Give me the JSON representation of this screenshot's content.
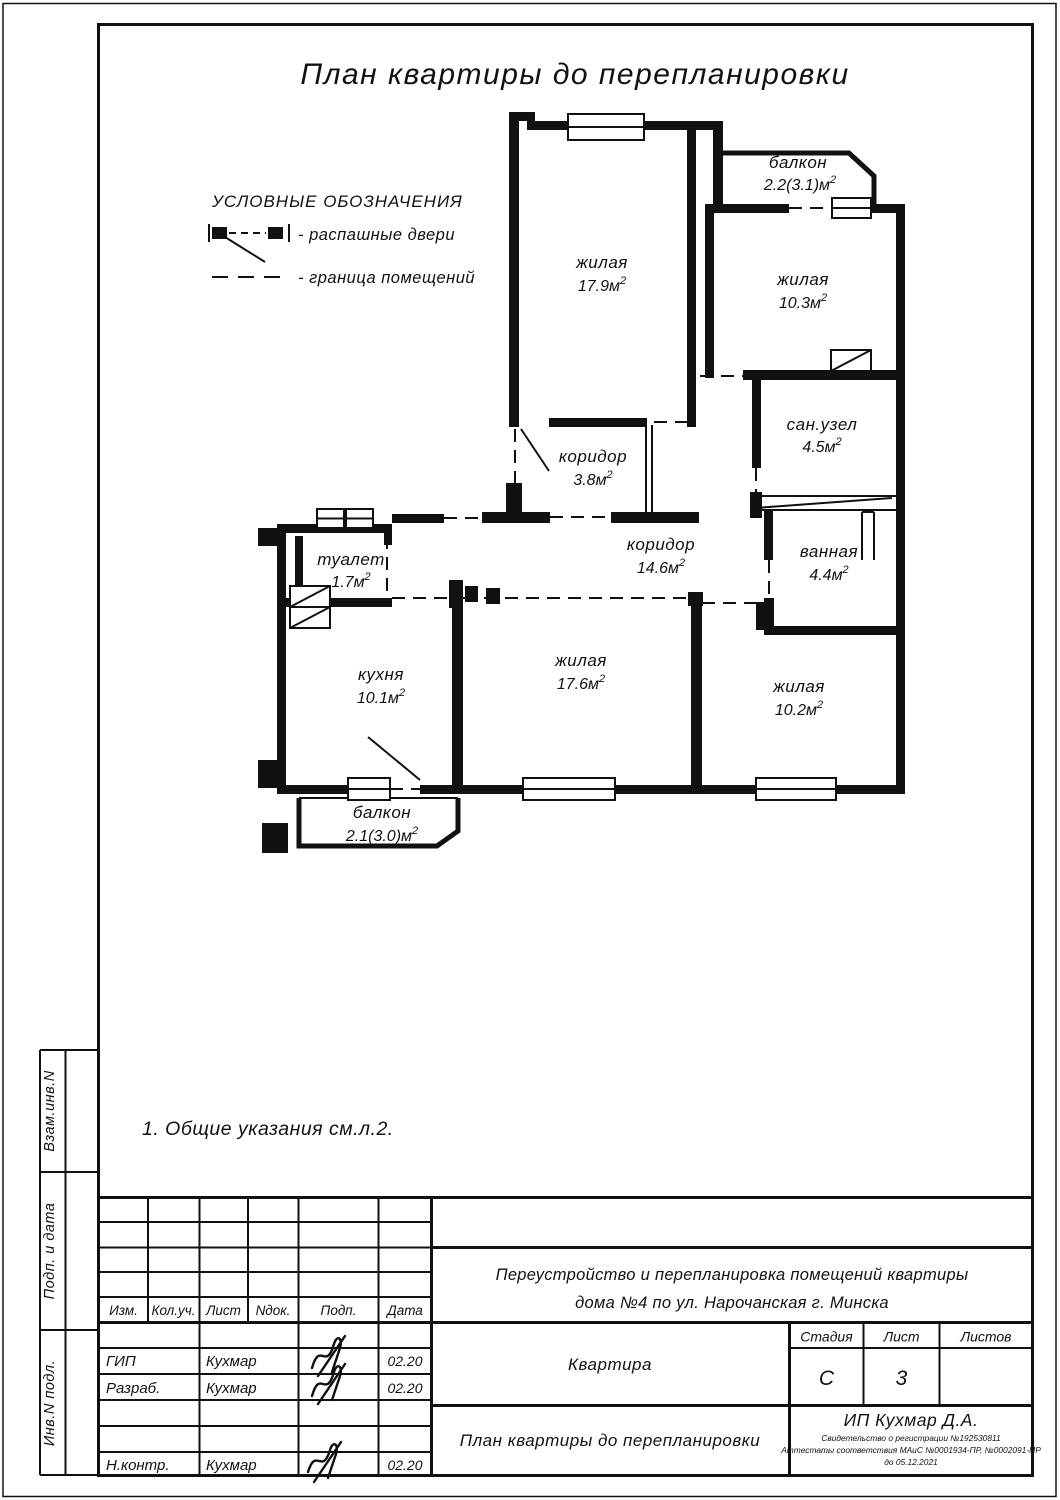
{
  "page": {
    "title": "План квартиры до перепланировки",
    "note": "1.  Общие указания см.л.2."
  },
  "legend": {
    "heading": "УСЛОВНЫЕ ОБОЗНАЧЕНИЯ",
    "door_label": "-  распашные двери",
    "boundary_label": "-  граница помещений"
  },
  "rooms": [
    {
      "name": "жилая",
      "area": "17.9м",
      "sup": "2"
    },
    {
      "name": "балкон",
      "area": "2.2(3.1)м",
      "sup": "2"
    },
    {
      "name": "жилая",
      "area": "10.3м",
      "sup": "2"
    },
    {
      "name": "сан.узел",
      "area": "4.5м",
      "sup": "2"
    },
    {
      "name": "ванная",
      "area": "4.4м",
      "sup": "2"
    },
    {
      "name": "коридор",
      "area": "3.8м",
      "sup": "2"
    },
    {
      "name": "коридор",
      "area": "14.6м",
      "sup": "2"
    },
    {
      "name": "туалет",
      "area": "1.7м",
      "sup": "2"
    },
    {
      "name": "кухня",
      "area": "10.1м",
      "sup": "2"
    },
    {
      "name": "жилая",
      "area": "17.6м",
      "sup": "2"
    },
    {
      "name": "жилая",
      "area": "10.2м",
      "sup": "2"
    },
    {
      "name": "балкон",
      "area": "2.1(3.0)м",
      "sup": "2"
    }
  ],
  "sidebar": {
    "labels": [
      "Взам.инв.N",
      "Подп. и дата",
      "Инв.N подл."
    ]
  },
  "titleblock": {
    "columns": [
      "Изм.",
      "Кол.уч.",
      "Лист",
      "Nдок.",
      "Подп.",
      "Дата"
    ],
    "rows": [
      {
        "role": "ГИП",
        "name": "Кухмар",
        "date": "02.20"
      },
      {
        "role": "Разраб.",
        "name": "Кухмар",
        "date": "02.20"
      },
      {
        "role": "Н.контр.",
        "name": "Кухмар",
        "date": "02.20"
      }
    ],
    "project_line1": "Переустройство и перепланировка помещений квартиры",
    "project_line2": "дома №4  по ул. Нарочанская г. Минска",
    "object": "Квартира",
    "stage_label": "Стадия",
    "stage_value": "С",
    "sheet_label": "Лист",
    "sheet_value": "3",
    "sheets_label": "Листов",
    "sheets_value": "",
    "drawing_title": "План квартиры до перепланировки",
    "company": "ИП Кухмар Д.А.",
    "cert_line1": "Свидетельство о регистрации №192530811",
    "cert_line2": "Аттестаты соответствия МАиС №0001934-ПР, №0002091-ПР",
    "cert_line3": "до 05.12.2021"
  }
}
